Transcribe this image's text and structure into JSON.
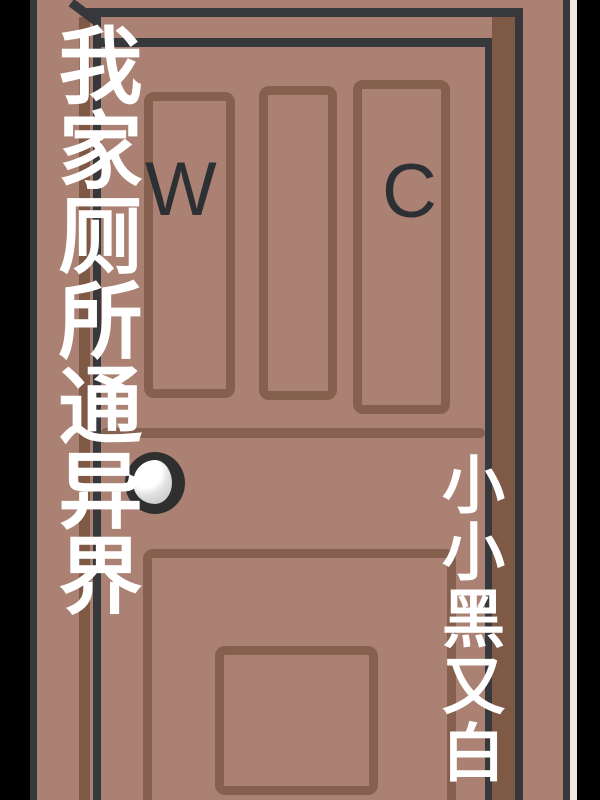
{
  "cover": {
    "title": "我家厕所通异界",
    "author": "小小黑又白",
    "door_letters": {
      "w": "W",
      "c": "C"
    }
  },
  "colors": {
    "background": "#000000",
    "door_base": "#aa8172",
    "frame_line": "#36383c",
    "panel_outline": "#85604f",
    "reveal_shadow": "#7e5946",
    "mid_groove": "#876251",
    "paper_edge": "#f2e9e2",
    "title_text": "#ffffff",
    "door_letter_text": "#2c2f33",
    "knob_outline": "#2f2f2f",
    "knob_fill": "#ffffff"
  }
}
